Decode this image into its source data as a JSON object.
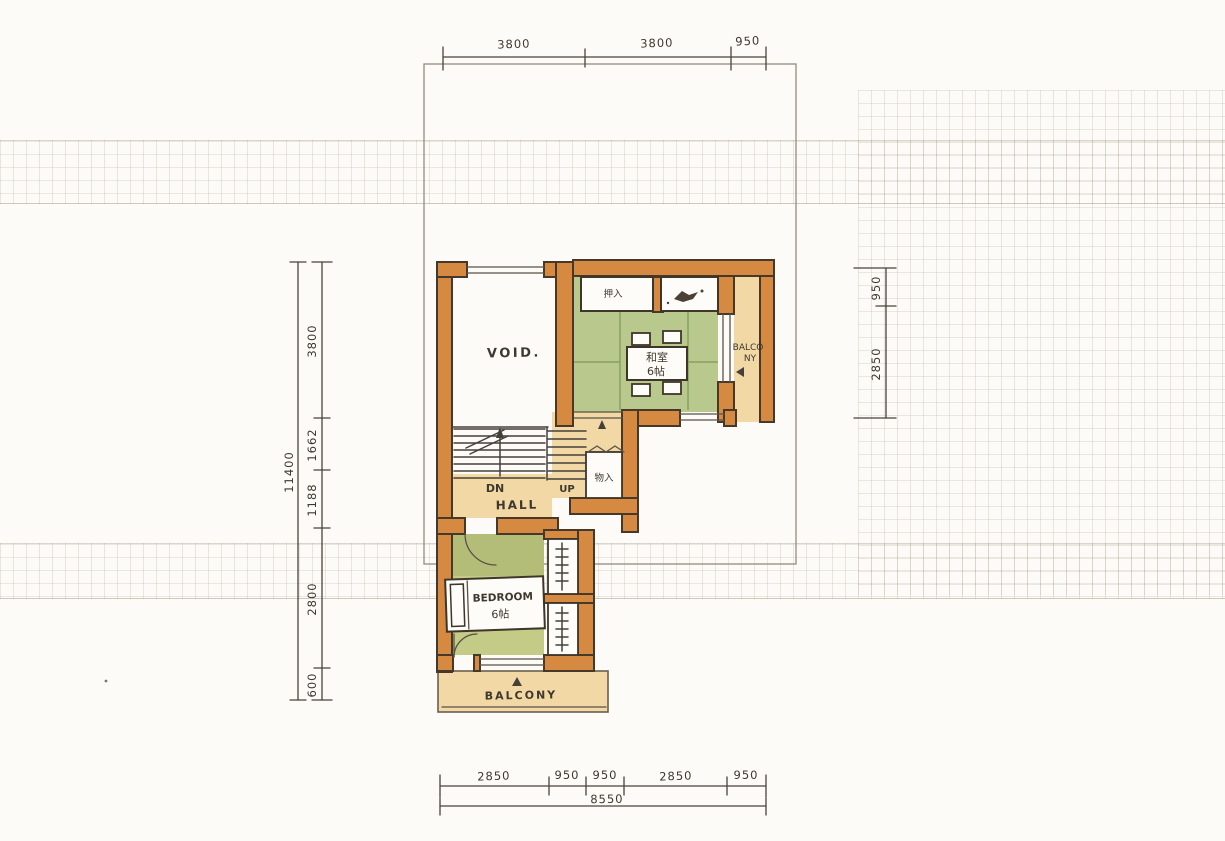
{
  "meta": {
    "drawing": "hand-drawn second floor plan sketch"
  },
  "dimensions": {
    "top": {
      "segments": [
        "3800",
        "3800",
        "950"
      ]
    },
    "bottom": {
      "segments": [
        "2850",
        "950",
        "950",
        "2850",
        "950"
      ],
      "total": "8550"
    },
    "left": {
      "segments": [
        "3800",
        "1662",
        "1188",
        "2800",
        "600"
      ],
      "total": "11400"
    },
    "right": {
      "segments": [
        "950",
        "2850"
      ]
    }
  },
  "rooms": {
    "void": "VOID.",
    "tatami": {
      "name": "和室",
      "size": "6帖"
    },
    "oshiire": "押入",
    "balcony_right": {
      "line1": "BALCO",
      "line2": "NY"
    },
    "storage": "物入",
    "hall": "HALL",
    "stairs": {
      "down": "DN",
      "up": "UP"
    },
    "bedroom": {
      "name": "BEDROOM",
      "size": "6帖"
    },
    "balcony_bottom": "BALCONY"
  },
  "colors": {
    "paper": "#fcfbf8",
    "wall": "#d68a41",
    "wall_outline": "#46392a",
    "tatami": "#b9c88c",
    "tatami_line": "#8ba064",
    "bedroom_floor": "#c4cb86",
    "bedroom_floor_dark": "#b3bd78",
    "wood_floor": "#f2d8a4",
    "ink": "#46403a",
    "dim_line": "#4a443a"
  }
}
